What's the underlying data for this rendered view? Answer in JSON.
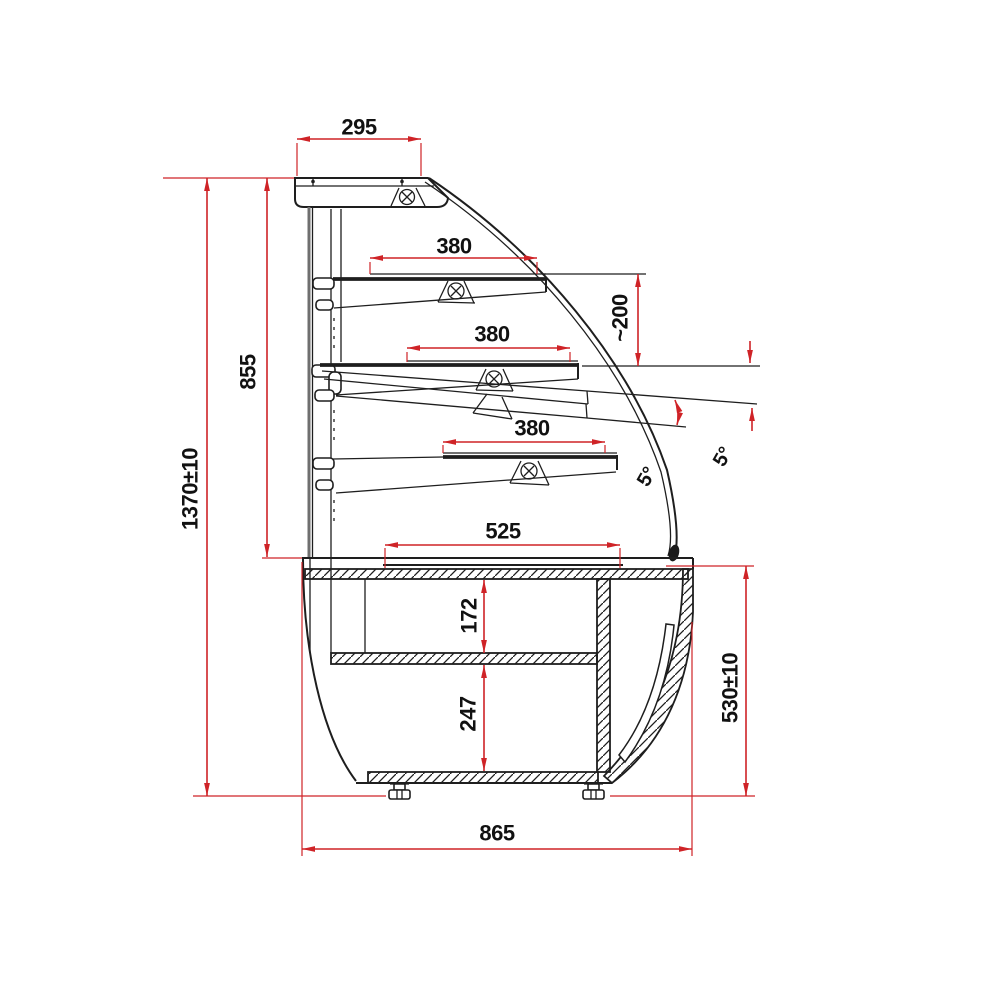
{
  "title": "Display case side section drawing",
  "colors": {
    "background": "#ffffff",
    "drawing_lines": "#1e1e1e",
    "dimension_lines": "#cf2327",
    "dimension_text": "#111111"
  },
  "icons": {
    "lamp": "circle-with-cross",
    "leveling_foot": "foot-glyph"
  },
  "dimensions": {
    "canopy_depth": {
      "label": "295"
    },
    "shelf_top_depth": {
      "label": "380"
    },
    "shelf_vertical_gap": {
      "label": "~200"
    },
    "shelf_zone_height": {
      "label": "855"
    },
    "shelf_middle_depth": {
      "label": "380"
    },
    "overall_height": {
      "label": "1370±10"
    },
    "shelf_bottom_depth": {
      "label": "380"
    },
    "shelf_tilt_near": {
      "label": "5°"
    },
    "shelf_tilt_far": {
      "label": "5°"
    },
    "deck_depth": {
      "label": "525"
    },
    "upper_compartment_height": {
      "label": "172"
    },
    "lower_compartment_height": {
      "label": "247"
    },
    "base_height": {
      "label": "530±10"
    },
    "overall_depth": {
      "label": "865"
    }
  }
}
